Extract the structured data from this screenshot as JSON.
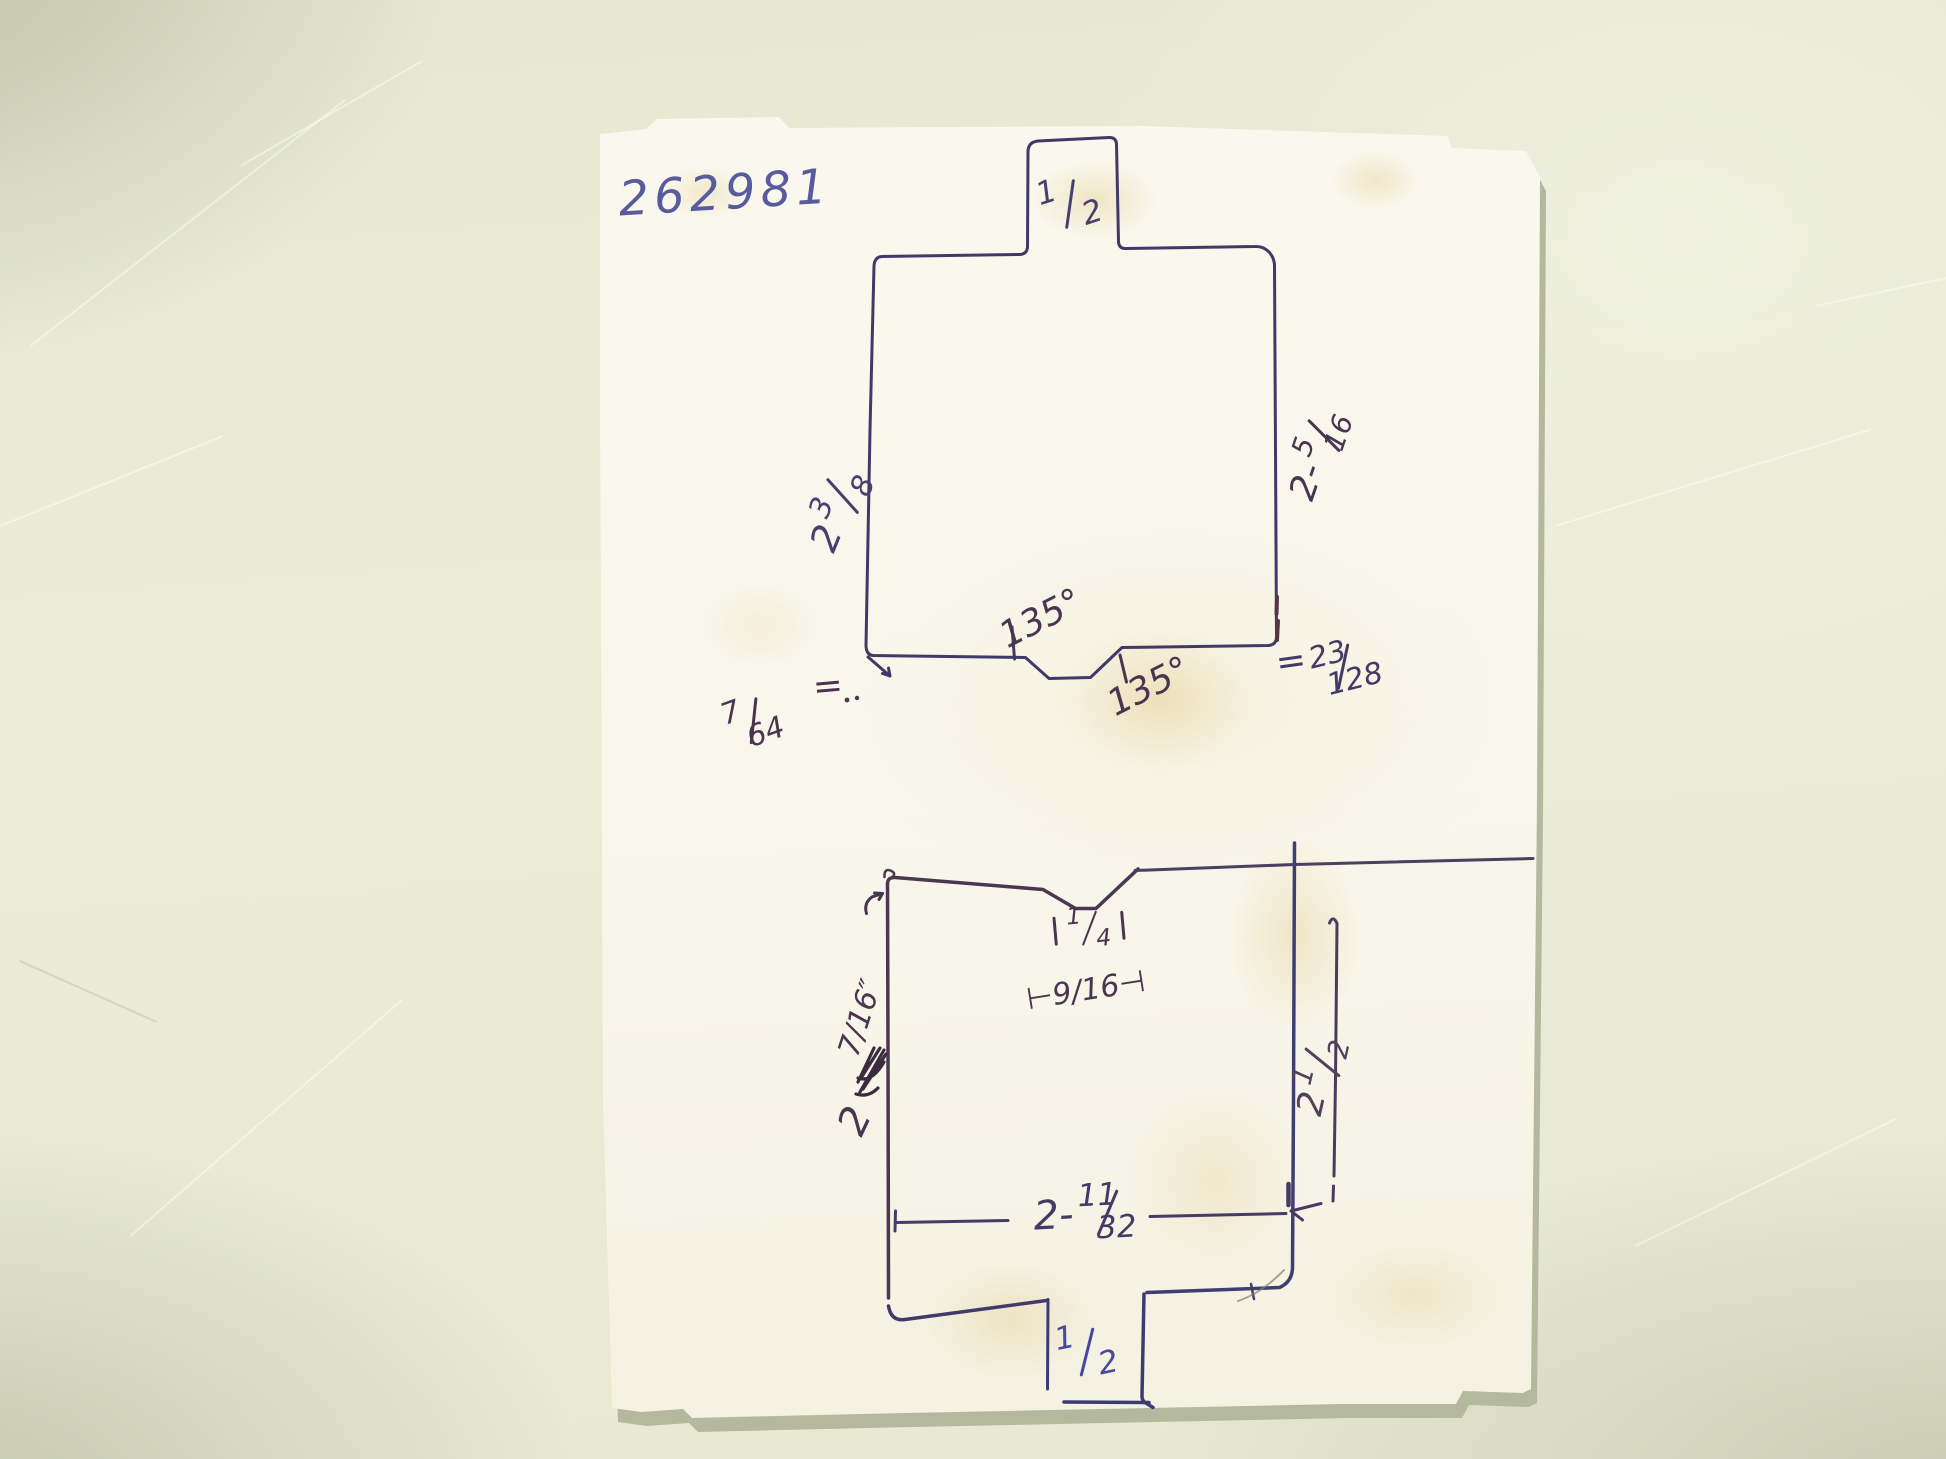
{
  "part_number": "262981",
  "top_shape": {
    "tab_frac": {
      "n": "1",
      "d": "2"
    },
    "left_dim": {
      "whole": "2",
      "frac": {
        "n": "3",
        "d": "8"
      }
    },
    "right_dim": {
      "prefix": "2-",
      "frac": {
        "n": "5",
        "d": "16"
      }
    },
    "angle_upper": "135°",
    "angle_lower": "135°",
    "left_gap_frac": {
      "n": "7",
      "d": "64"
    },
    "left_approx": "=",
    "right_equals": "=",
    "right_gap_frac": {
      "n": "23",
      "d": "128"
    }
  },
  "bottom_shape": {
    "notch_flat_frac": {
      "n": "1",
      "d": "4"
    },
    "notch_width": "⊢9/16⊣",
    "left_dim_whole": "2",
    "left_dim_frac": "7/16″",
    "width_dim": {
      "prefix": "2-",
      "frac": {
        "n": "11",
        "d": "32"
      }
    },
    "right_dim": {
      "whole": "2",
      "frac": {
        "n": "1",
        "d": "2"
      }
    },
    "tab_frac": {
      "n": "1",
      "d": "2"
    }
  },
  "colors": {
    "table": "#e9ebd4",
    "paper": "#f9f7ec",
    "ink_blue": "#3f3a68",
    "ink_purple": "#4a3550",
    "ink_bright_blue": "#4549a4",
    "part_number_ink": "#585c9e"
  }
}
